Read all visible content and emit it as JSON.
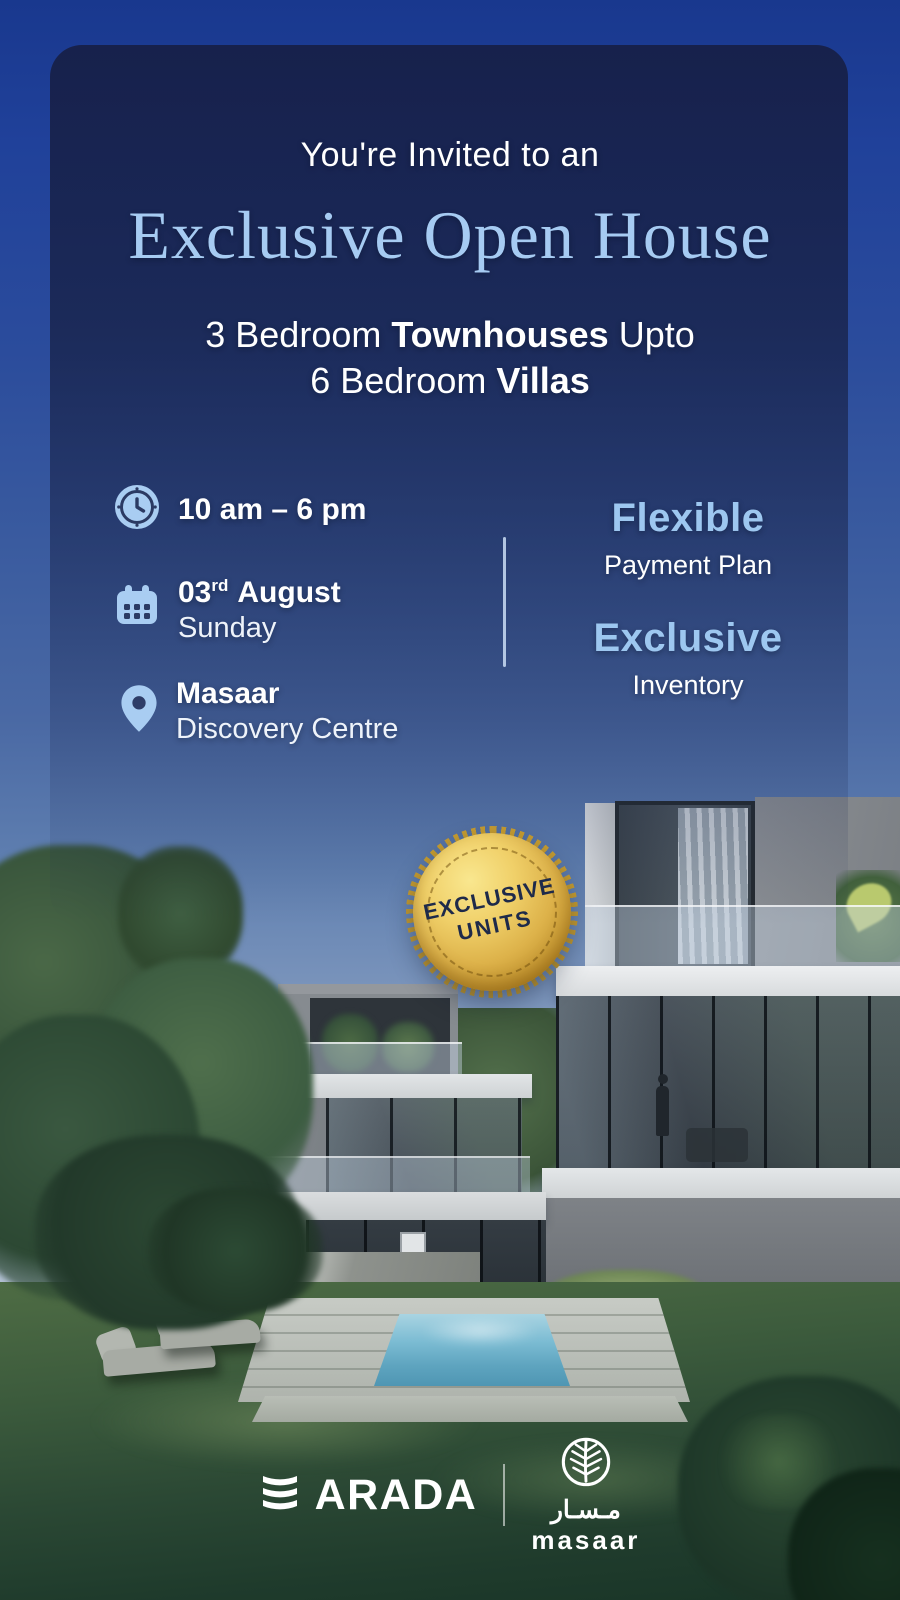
{
  "header": {
    "kicker": "You're Invited to an",
    "title": "Exclusive Open House",
    "subtitle": {
      "l1_regular": "3 Bedroom ",
      "l1_bold": "Townhouses",
      "l1_tail": " Upto",
      "l2_regular": "6 Bedroom ",
      "l2_bold": "Villas"
    }
  },
  "details": {
    "time": {
      "icon": "clock",
      "text": "10 am – 6 pm"
    },
    "date": {
      "icon": "calendar",
      "day": "03",
      "ordinal": "rd",
      "month": "August",
      "weekday": "Sunday"
    },
    "location": {
      "icon": "location-pin",
      "name": "Masaar",
      "venue": "Discovery Centre"
    }
  },
  "features": [
    {
      "highlight": "Flexible",
      "label": "Payment Plan"
    },
    {
      "highlight": "Exclusive",
      "label": "Inventory"
    }
  ],
  "seal": {
    "icon": "gold-serrated-seal",
    "line1": "EXCLUSIVE",
    "line2": "UNITS"
  },
  "footer": {
    "arada_icon": "arada-triple-arc",
    "arada_wordmark": "ARADA",
    "masaar_icon": "leaf-in-circle",
    "masaar_arabic": "مـسـار",
    "masaar_wordmark": "masaar"
  },
  "colors": {
    "accent_light_blue": "#a6cbf2",
    "icon_blue": "#a9cdf2",
    "card_navy": "#161c3e",
    "sky_top_blue": "#19388e",
    "seal_gold": "#ddb24a",
    "seal_text_navy": "#1e2a4a",
    "pool_teal": "#6fb2cb",
    "lawn_green": "#2b4834"
  }
}
